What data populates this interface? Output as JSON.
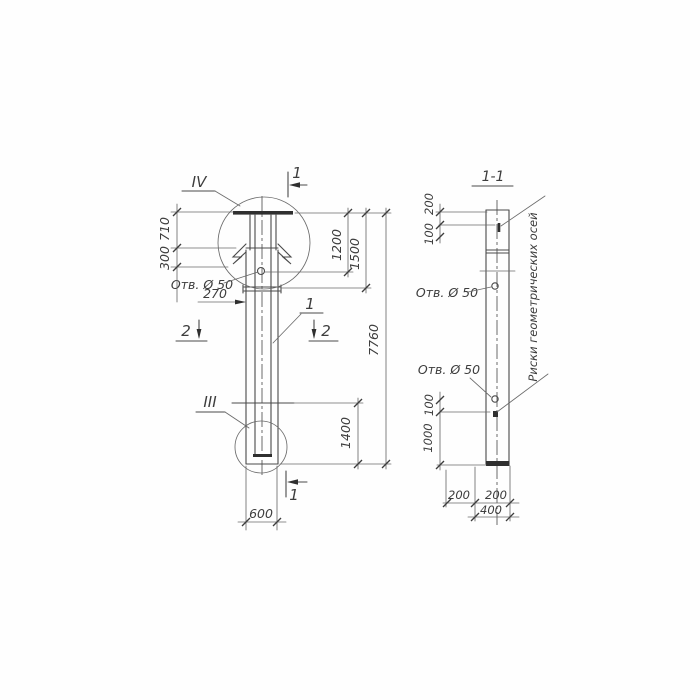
{
  "page": {
    "background": "#fefefe",
    "ink": "#3d3d3d"
  },
  "front_view": {
    "detail_marker_top": "IV",
    "detail_marker_bottom": "III",
    "section_cut_1": "1",
    "section_cut_2": "2",
    "part_label": "1",
    "hole_label": "Отв. Ø 50",
    "dim_710": "710",
    "dim_300": "300",
    "dim_270": "270",
    "dim_1200": "1200",
    "dim_1500": "1500",
    "dim_7760": "7760",
    "dim_1400": "1400",
    "dim_600": "600"
  },
  "section_view": {
    "title": "1-1",
    "dim_200_top": "200",
    "dim_100_top": "100",
    "hole_label_upper": "Отв. Ø 50",
    "hole_label_lower": "Отв. Ø 50",
    "dim_100_mid": "100",
    "dim_1000": "1000",
    "dim_200_left": "200",
    "dim_200_right": "200",
    "dim_400": "400",
    "axes_note": "Риски геометрических осей"
  }
}
